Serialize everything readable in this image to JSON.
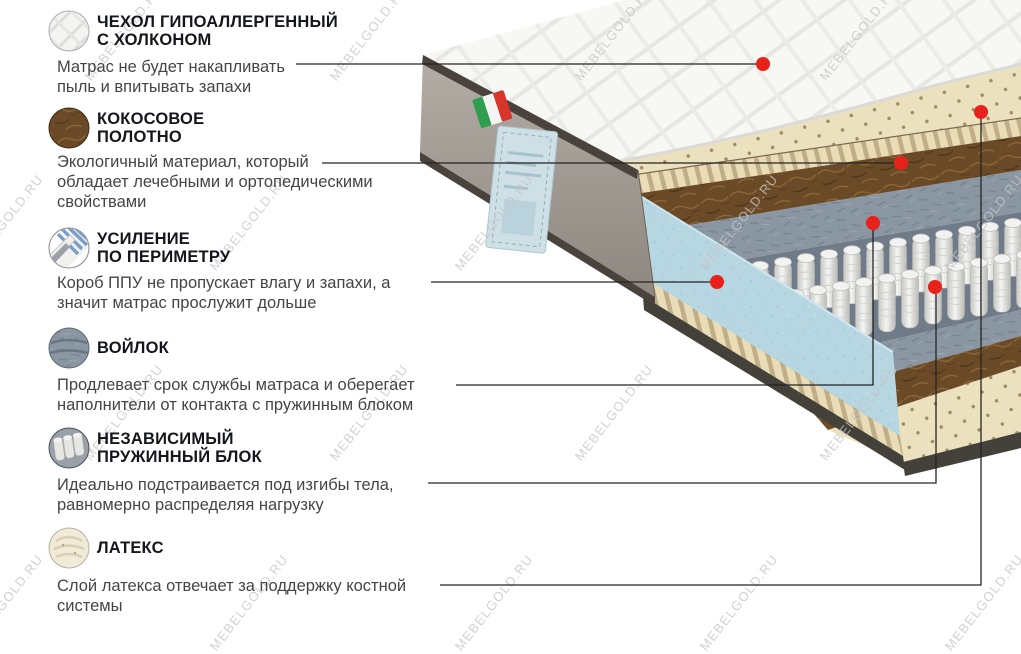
{
  "watermark": {
    "text": "MEBELGOLD.RU",
    "color": "#c6c6c6"
  },
  "colors": {
    "background": "#ffffff",
    "title_text": "#14161b",
    "desc_text": "#454549",
    "callout_line": "#242424",
    "callout_dot": "#e8211a",
    "quilt": "#f7f7f4",
    "latex": "#ece1bf",
    "coconut": "#6b4a28",
    "felt": "#8b96a3",
    "foam_blue": "#b6d6e2",
    "side_panel": "#a39b93",
    "binding": "#4a423c"
  },
  "sections": [
    {
      "id": "cover",
      "icon": "quilted-cover-icon",
      "title_lines": [
        "ЧЕХОЛ ГИПОАЛЛЕРГЕННЫЙ",
        "С ХОЛКОНОМ"
      ],
      "desc_lines": [
        "Матрас не будет накапливать",
        "пыль и впитывать запахи"
      ]
    },
    {
      "id": "coconut",
      "icon": "coconut-coir-icon",
      "title_lines": [
        "КОКОСОВОЕ",
        "ПОЛОТНО"
      ],
      "desc_lines": [
        "Экологичный материал, который",
        "обладает лечебными и ортопедическими",
        "свойствами"
      ]
    },
    {
      "id": "perimeter",
      "icon": "perimeter-foam-icon",
      "title_lines": [
        "УСИЛЕНИЕ",
        "ПО ПЕРИМЕТРУ"
      ],
      "desc_lines": [
        "Короб ППУ не пропускает влагу и запахи, а",
        "значит матрас прослужит дольше"
      ]
    },
    {
      "id": "felt",
      "icon": "felt-icon",
      "title_lines": [
        "ВОЙЛОК"
      ],
      "desc_lines": [
        "Продлевает срок службы матраса  и оберегает",
        "наполнители от контакта с пружинным блоком"
      ]
    },
    {
      "id": "springs",
      "icon": "pocket-springs-icon",
      "title_lines": [
        "НЕЗАВИСИМЫЙ",
        "ПРУЖИННЫЙ БЛОК"
      ],
      "desc_lines": [
        "Идеально подстраивается под изгибы тела,",
        "равномерно распределяя нагрузку"
      ]
    },
    {
      "id": "latex",
      "icon": "latex-icon",
      "title_lines": [
        "ЛАТЕКС"
      ],
      "desc_lines": [
        "Слой латекса отвечает за поддержку костной",
        "системы"
      ]
    }
  ],
  "callouts": {
    "line_color": "#242424",
    "dot_color": "#e8211a",
    "items": [
      {
        "id": "cover",
        "points": [
          [
            296,
            64
          ],
          [
            757,
            64
          ]
        ],
        "dot": [
          763,
          64
        ]
      },
      {
        "id": "coconut",
        "points": [
          [
            322,
            163
          ],
          [
            894,
            163
          ]
        ],
        "dot": [
          901,
          163
        ]
      },
      {
        "id": "perimeter",
        "points": [
          [
            431,
            282
          ],
          [
            710,
            282
          ]
        ],
        "dot": [
          717,
          282
        ]
      },
      {
        "id": "felt",
        "points": [
          [
            456,
            385
          ],
          [
            873,
            385
          ],
          [
            873,
            230
          ]
        ],
        "dot": [
          873,
          223
        ]
      },
      {
        "id": "springs",
        "points": [
          [
            428,
            483
          ],
          [
            936,
            483
          ],
          [
            936,
            294
          ]
        ],
        "dot": [
          935,
          287
        ]
      },
      {
        "id": "latex",
        "points": [
          [
            440,
            585
          ],
          [
            981,
            585
          ],
          [
            981,
            119
          ]
        ],
        "dot": [
          981,
          112
        ]
      }
    ]
  }
}
